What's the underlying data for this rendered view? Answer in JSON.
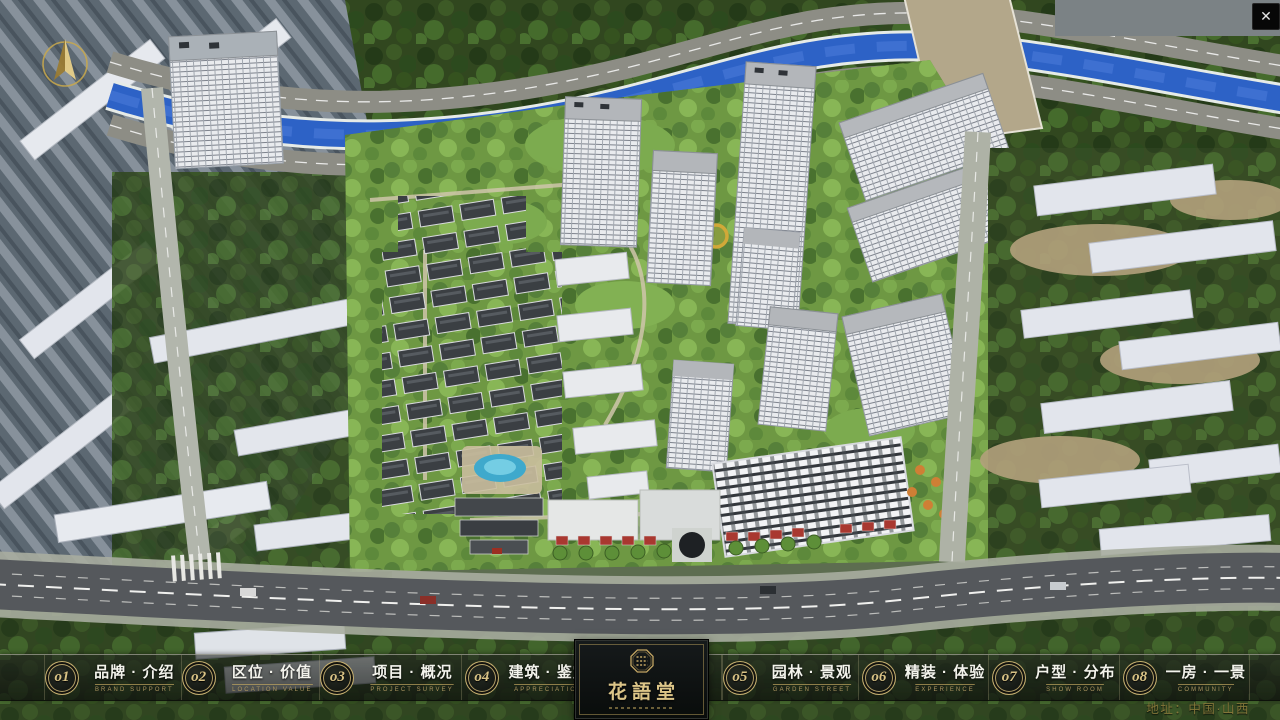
{
  "window": {
    "close_icon": "✕"
  },
  "nav": {
    "items": [
      {
        "num": "o1",
        "title": "品牌 · 介绍",
        "caption": "BRAND SUPPORT"
      },
      {
        "num": "o2",
        "title": "区位 · 价值",
        "caption": "LOCATION VALUE"
      },
      {
        "num": "o3",
        "title": "项目 · 概况",
        "caption": "PROJECT SURVEY"
      },
      {
        "num": "o4",
        "title": "建筑 · 鉴赏",
        "caption": "APPRECIATION"
      },
      {
        "num": "o5",
        "title": "园林 · 景观",
        "caption": "GARDEN STREET"
      },
      {
        "num": "o6",
        "title": "精装 · 体验",
        "caption": "EXPERIENCE"
      },
      {
        "num": "o7",
        "title": "户型 · 分布",
        "caption": "SHOW ROOM"
      },
      {
        "num": "o8",
        "title": "一房 · 一景",
        "caption": "COMMUNITY"
      }
    ]
  },
  "logo": {
    "title": "花語堂"
  },
  "footer": {
    "address": "地址：中国·山西"
  },
  "icons": {
    "close": "close-icon",
    "compass": "compass-icon",
    "seal": "logo-seal-icon"
  },
  "colors": {
    "gold": "#cdb674",
    "caption_gold": "#ab9560",
    "bar_bg": "rgba(20,24,20,0.65)",
    "river_blue": "#2d62c6",
    "grass_green": "#6f9a43",
    "tree_dark": "#31471f",
    "asphalt": "#55585c",
    "building_white": "#e9ebee",
    "text_white": "#f3f3ec"
  }
}
